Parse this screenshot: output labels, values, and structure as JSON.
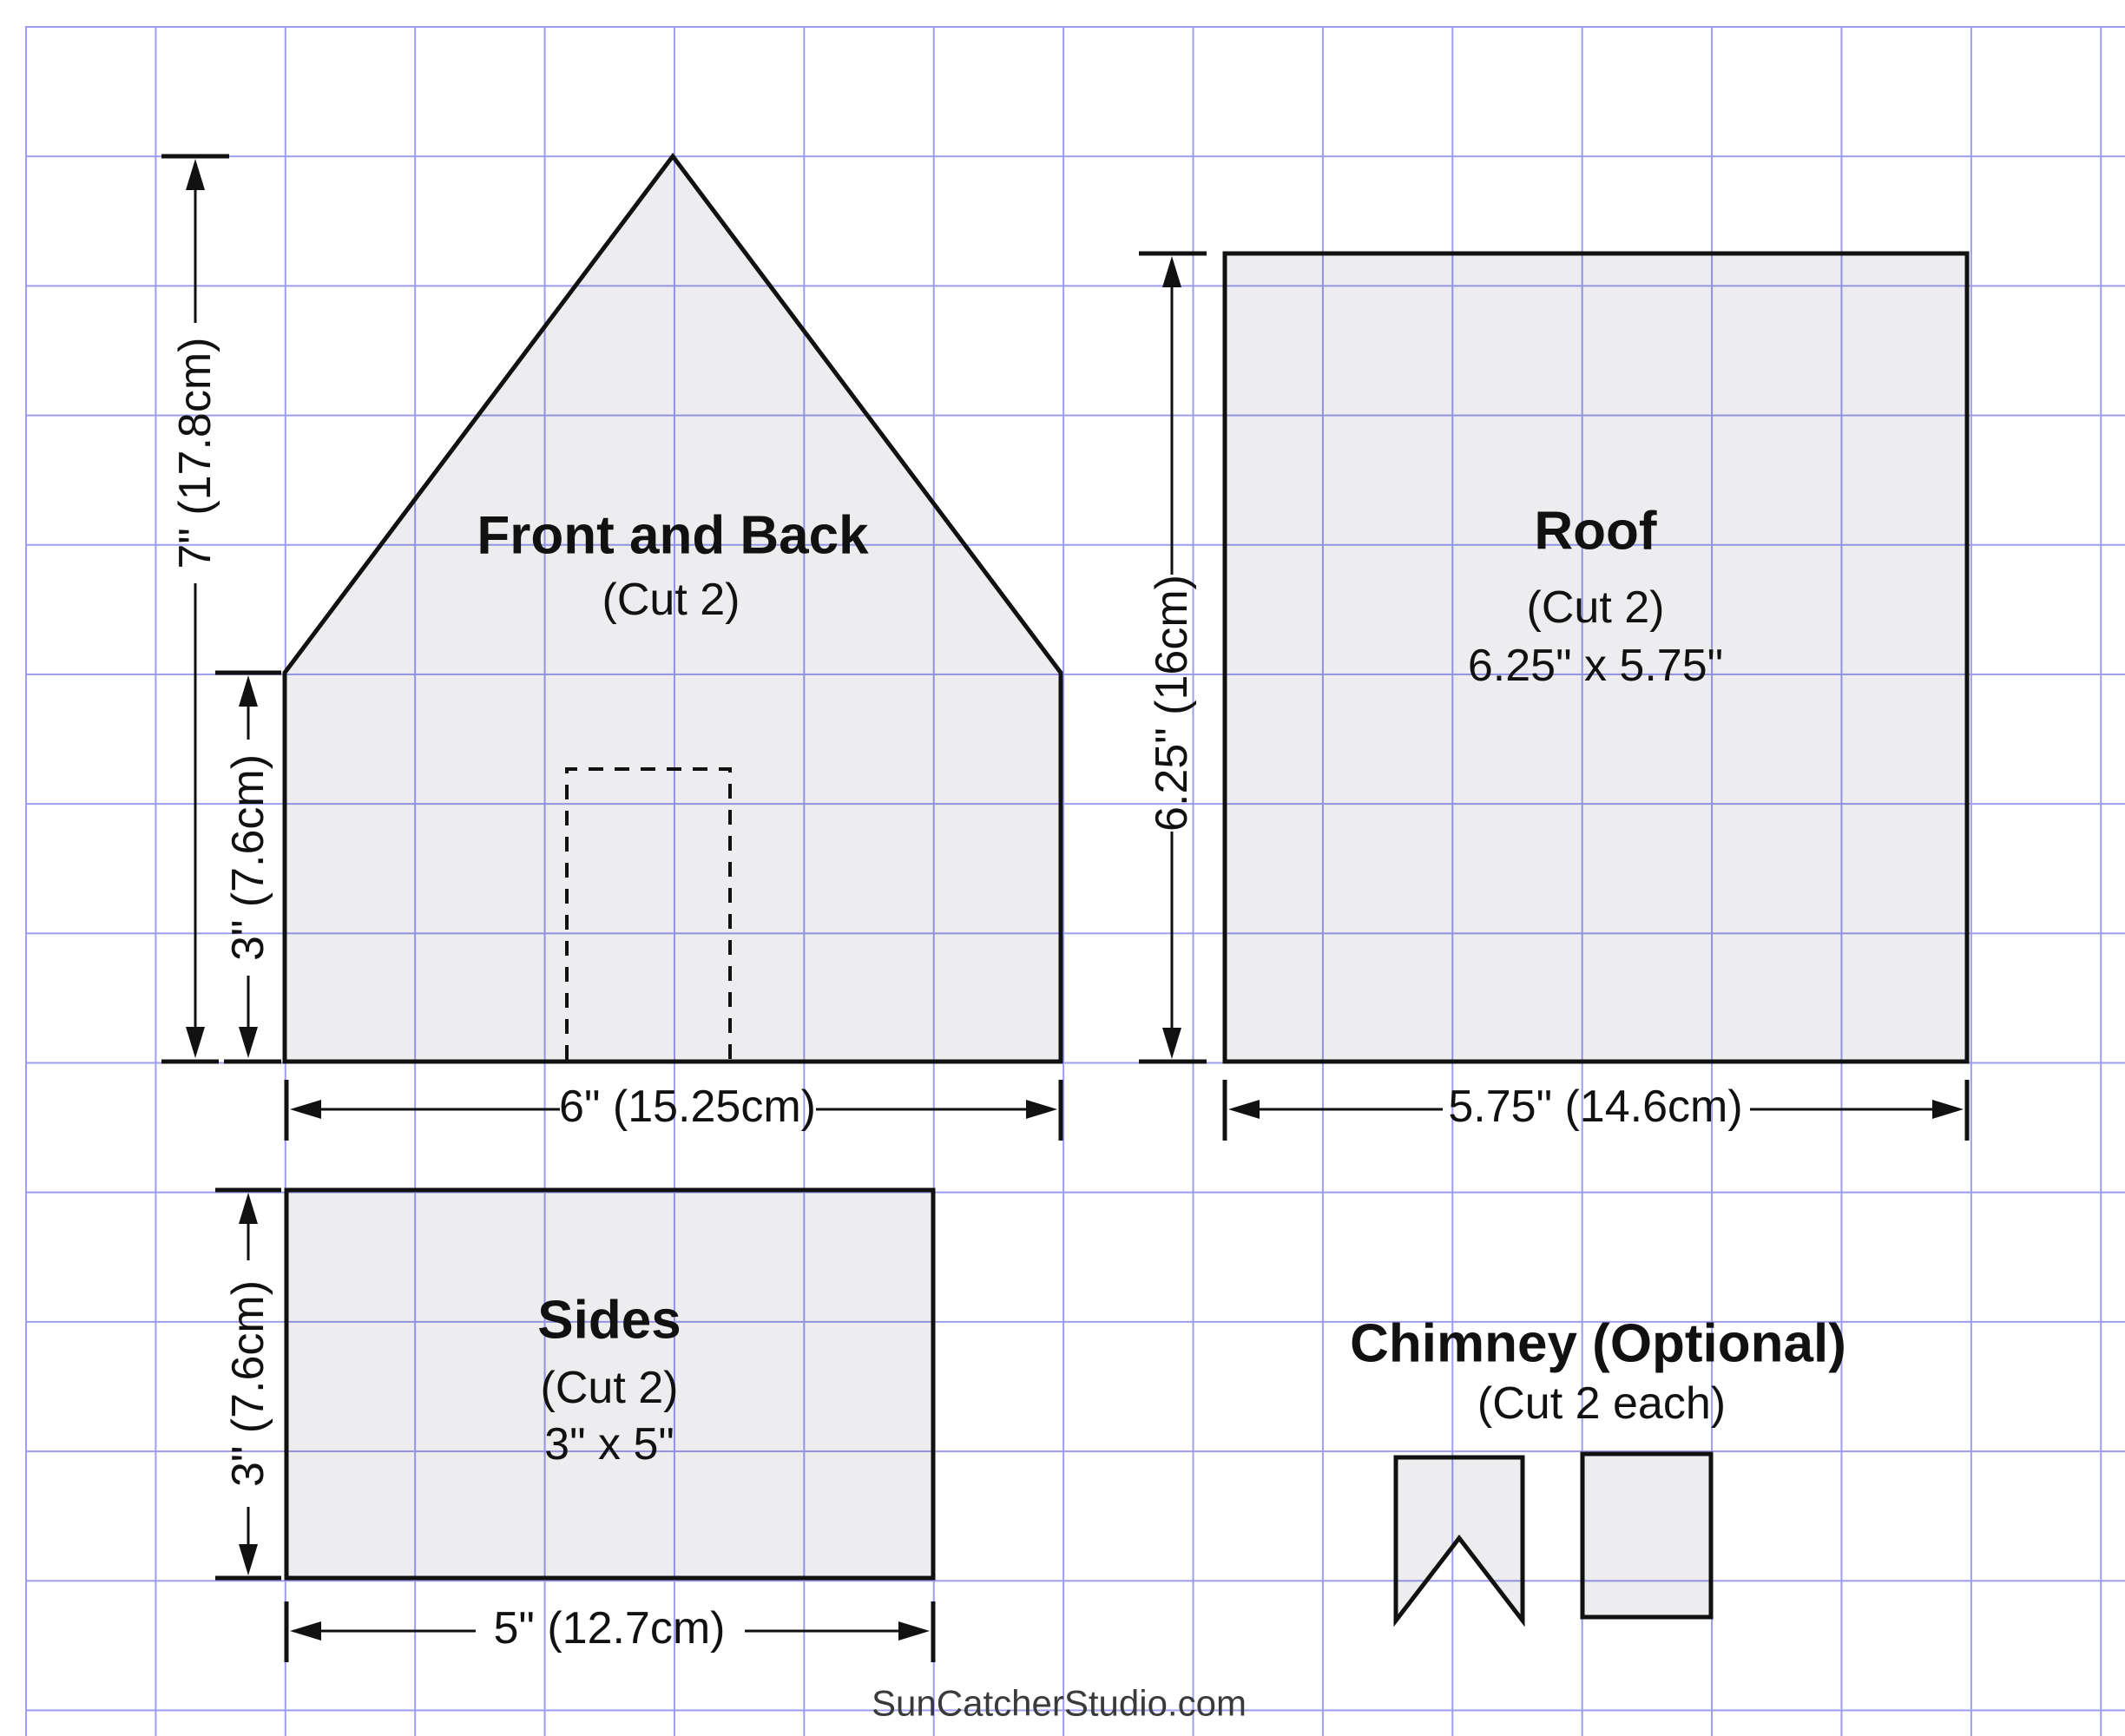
{
  "colors": {
    "grid_line": "#9d9df0",
    "piece_fill": "rgba(15,15,40,0.075)",
    "ink": "#111111",
    "footer_ink": "#3a3a3a"
  },
  "pieces": {
    "front_back": {
      "title": "Front and Back",
      "subtitle": "(Cut 2)"
    },
    "roof": {
      "title": "Roof",
      "subtitle": "(Cut 2)",
      "size_label": "6.25\" x 5.75\""
    },
    "sides": {
      "title": "Sides",
      "subtitle": "(Cut 2)",
      "size_label": "3\" x 5\""
    },
    "chimney": {
      "title": "Chimney (Optional)",
      "subtitle": "(Cut 2 each)"
    }
  },
  "dimensions": {
    "front_back_height": "7\" (17.8cm)",
    "front_back_wall_height": "3\" (7.6cm)",
    "front_back_width": "6\" (15.25cm)",
    "roof_height": "6.25\" (16cm)",
    "roof_width": "5.75\" (14.6cm)",
    "sides_height": "3\" (7.6cm)",
    "sides_width": "5\" (12.7cm)"
  },
  "footer": {
    "credit": "SunCatcherStudio.com"
  }
}
